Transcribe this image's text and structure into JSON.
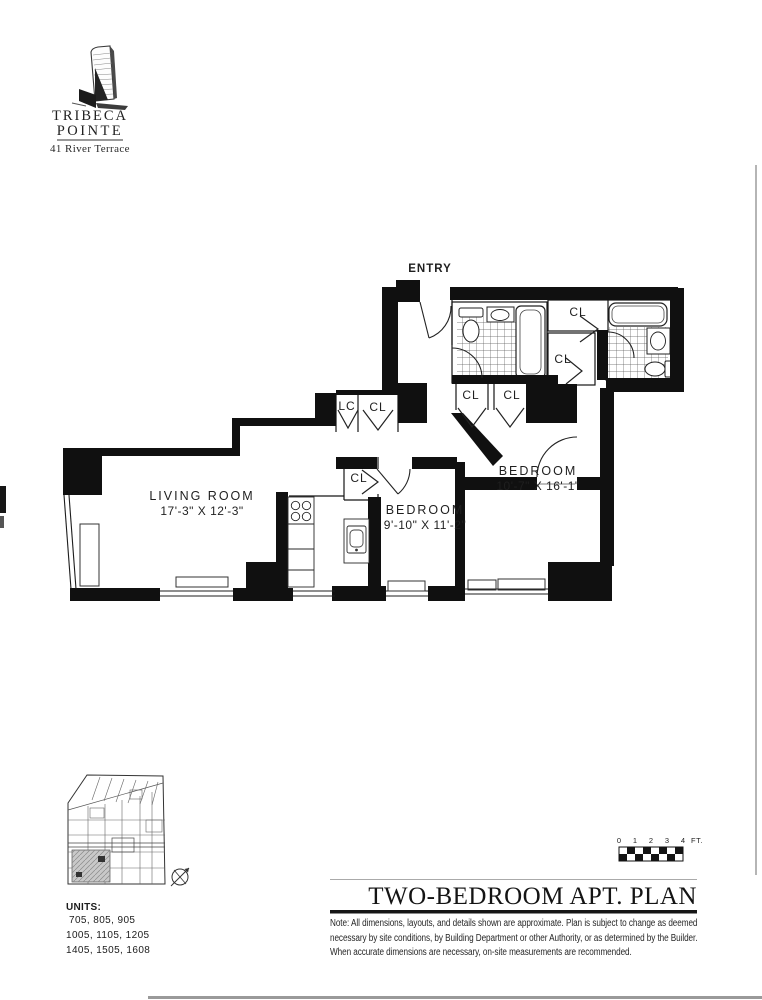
{
  "logo": {
    "line1": "TRIBECA",
    "line2": "POINTE",
    "address": "41 River Terrace"
  },
  "plan": {
    "entry_label": "ENTRY",
    "rooms": [
      {
        "name": "LIVING ROOM",
        "dims": "17'-3\" X 12'-3\""
      },
      {
        "name": "BEDROOM",
        "dims": "9'-10\" X 11'-2\""
      },
      {
        "name": "BEDROOM",
        "dims": "10'-7\" X 16'-1\""
      }
    ],
    "closets": {
      "linen": "LC",
      "closet": "CL"
    }
  },
  "key_plan": {
    "units_label": "UNITS:",
    "unit_rows": [
      "705, 805, 905",
      "1005, 1105, 1205",
      "1405, 1505, 1608"
    ]
  },
  "scale_bar": {
    "ticks": [
      "0",
      "1",
      "2",
      "3",
      "4"
    ],
    "unit_label": "FT."
  },
  "title_block": {
    "title": "TWO-BEDROOM APT. PLAN",
    "note": "Note: All dimensions, layouts, and details shown are approximate. Plan is subject to change as deemed necessary by site conditions, by Building Department or other Authority, or as determined by the Builder. When accurate dimensions are necessary, on-site measurements are recommended."
  },
  "colors": {
    "ink": "#1c1c1c",
    "wall": "#101010",
    "paper": "#ffffff"
  }
}
